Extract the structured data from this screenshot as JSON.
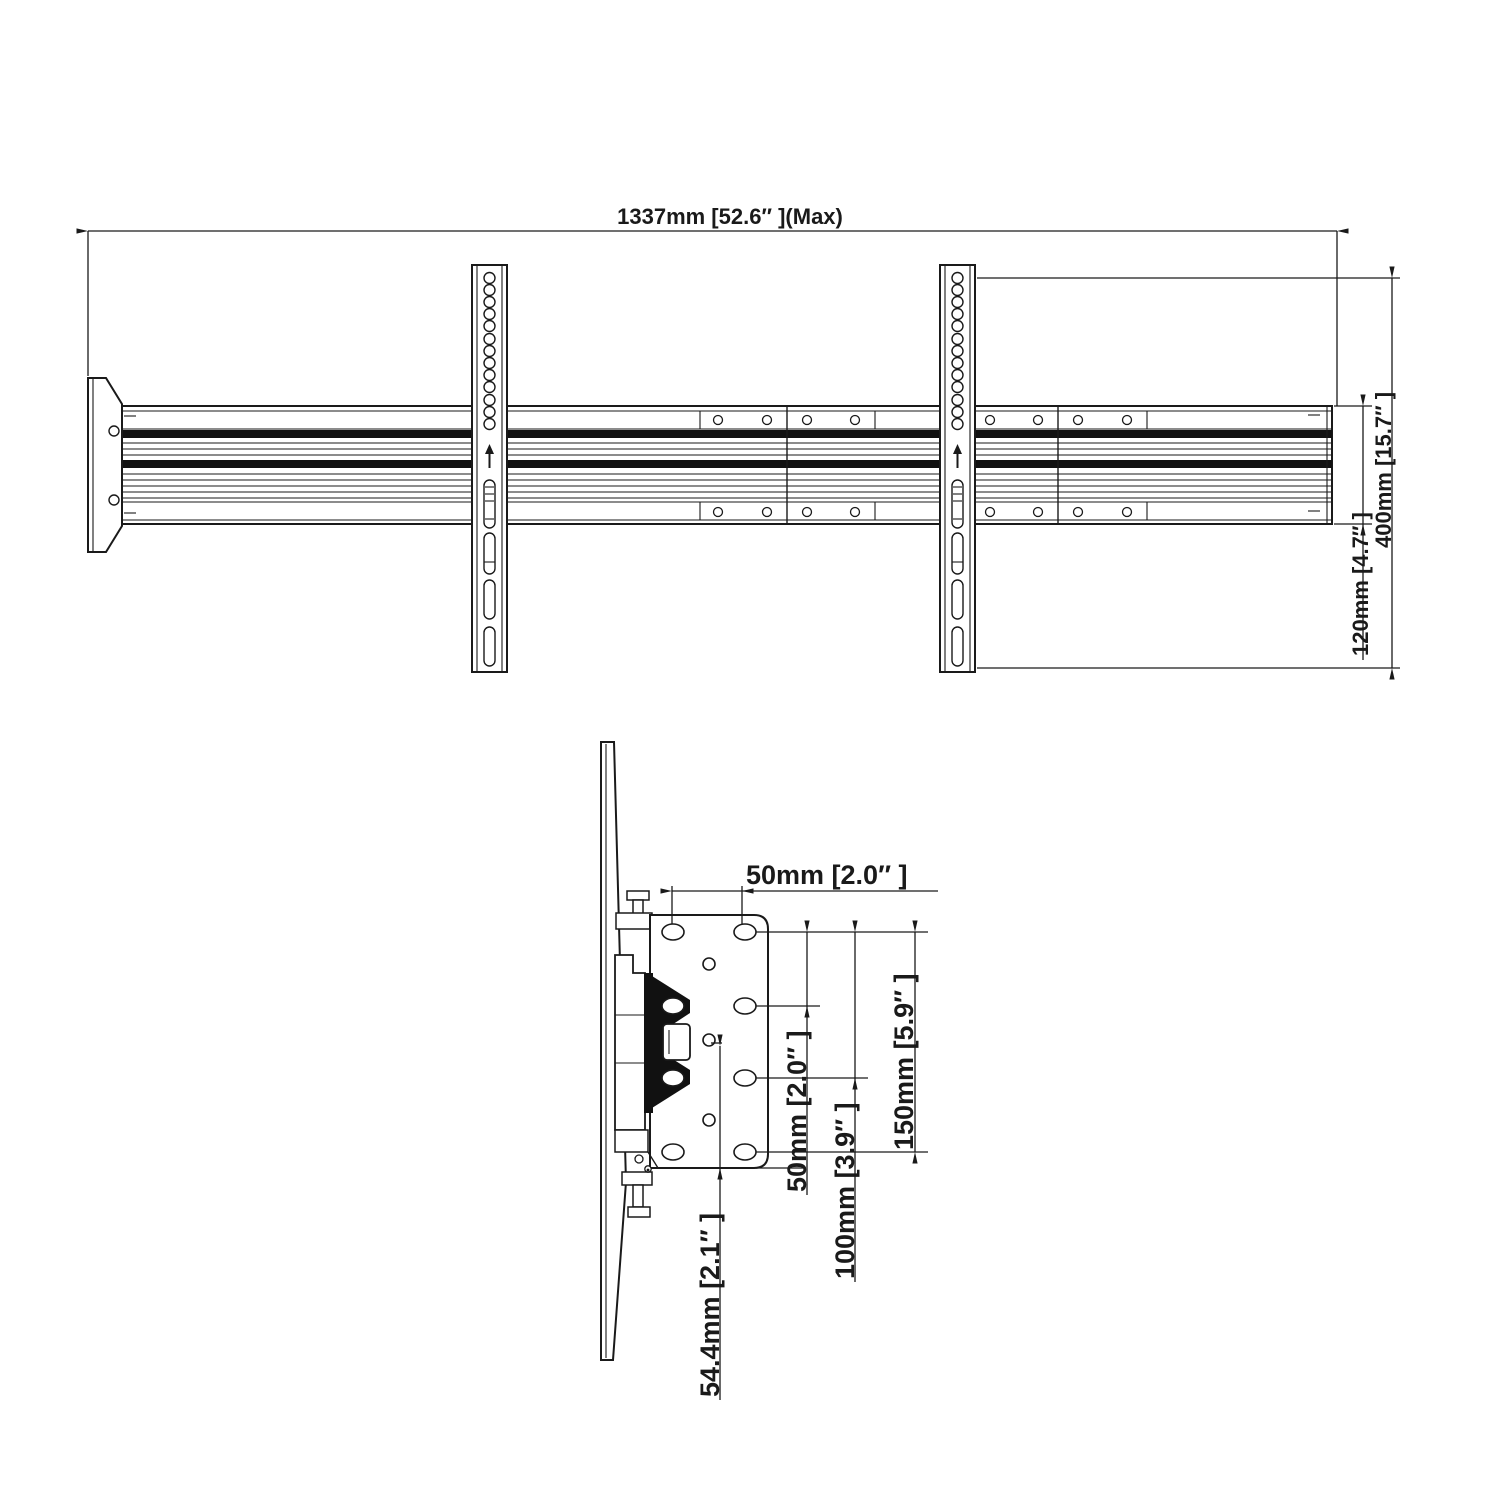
{
  "title": "Dual-screen TV mount technical drawing",
  "colors": {
    "line": "#1a1a1a",
    "background": "#ffffff"
  },
  "top_view": {
    "overall_width": "1337mm [52.6″  ](Max)",
    "bracket_height": "400mm [15.7″ ]",
    "rail_height": "120mm [4.7″ ]"
  },
  "side_view": {
    "hole_spacing_top": "50mm [2.0″  ]",
    "vesa_vertical_50": "50mm [2.0″ ]",
    "vesa_vertical_100": "100mm [3.9″ ]",
    "vesa_vertical_150": "150mm [5.9″ ]",
    "bottom_offset": "54.4mm [2.1″ ]"
  }
}
